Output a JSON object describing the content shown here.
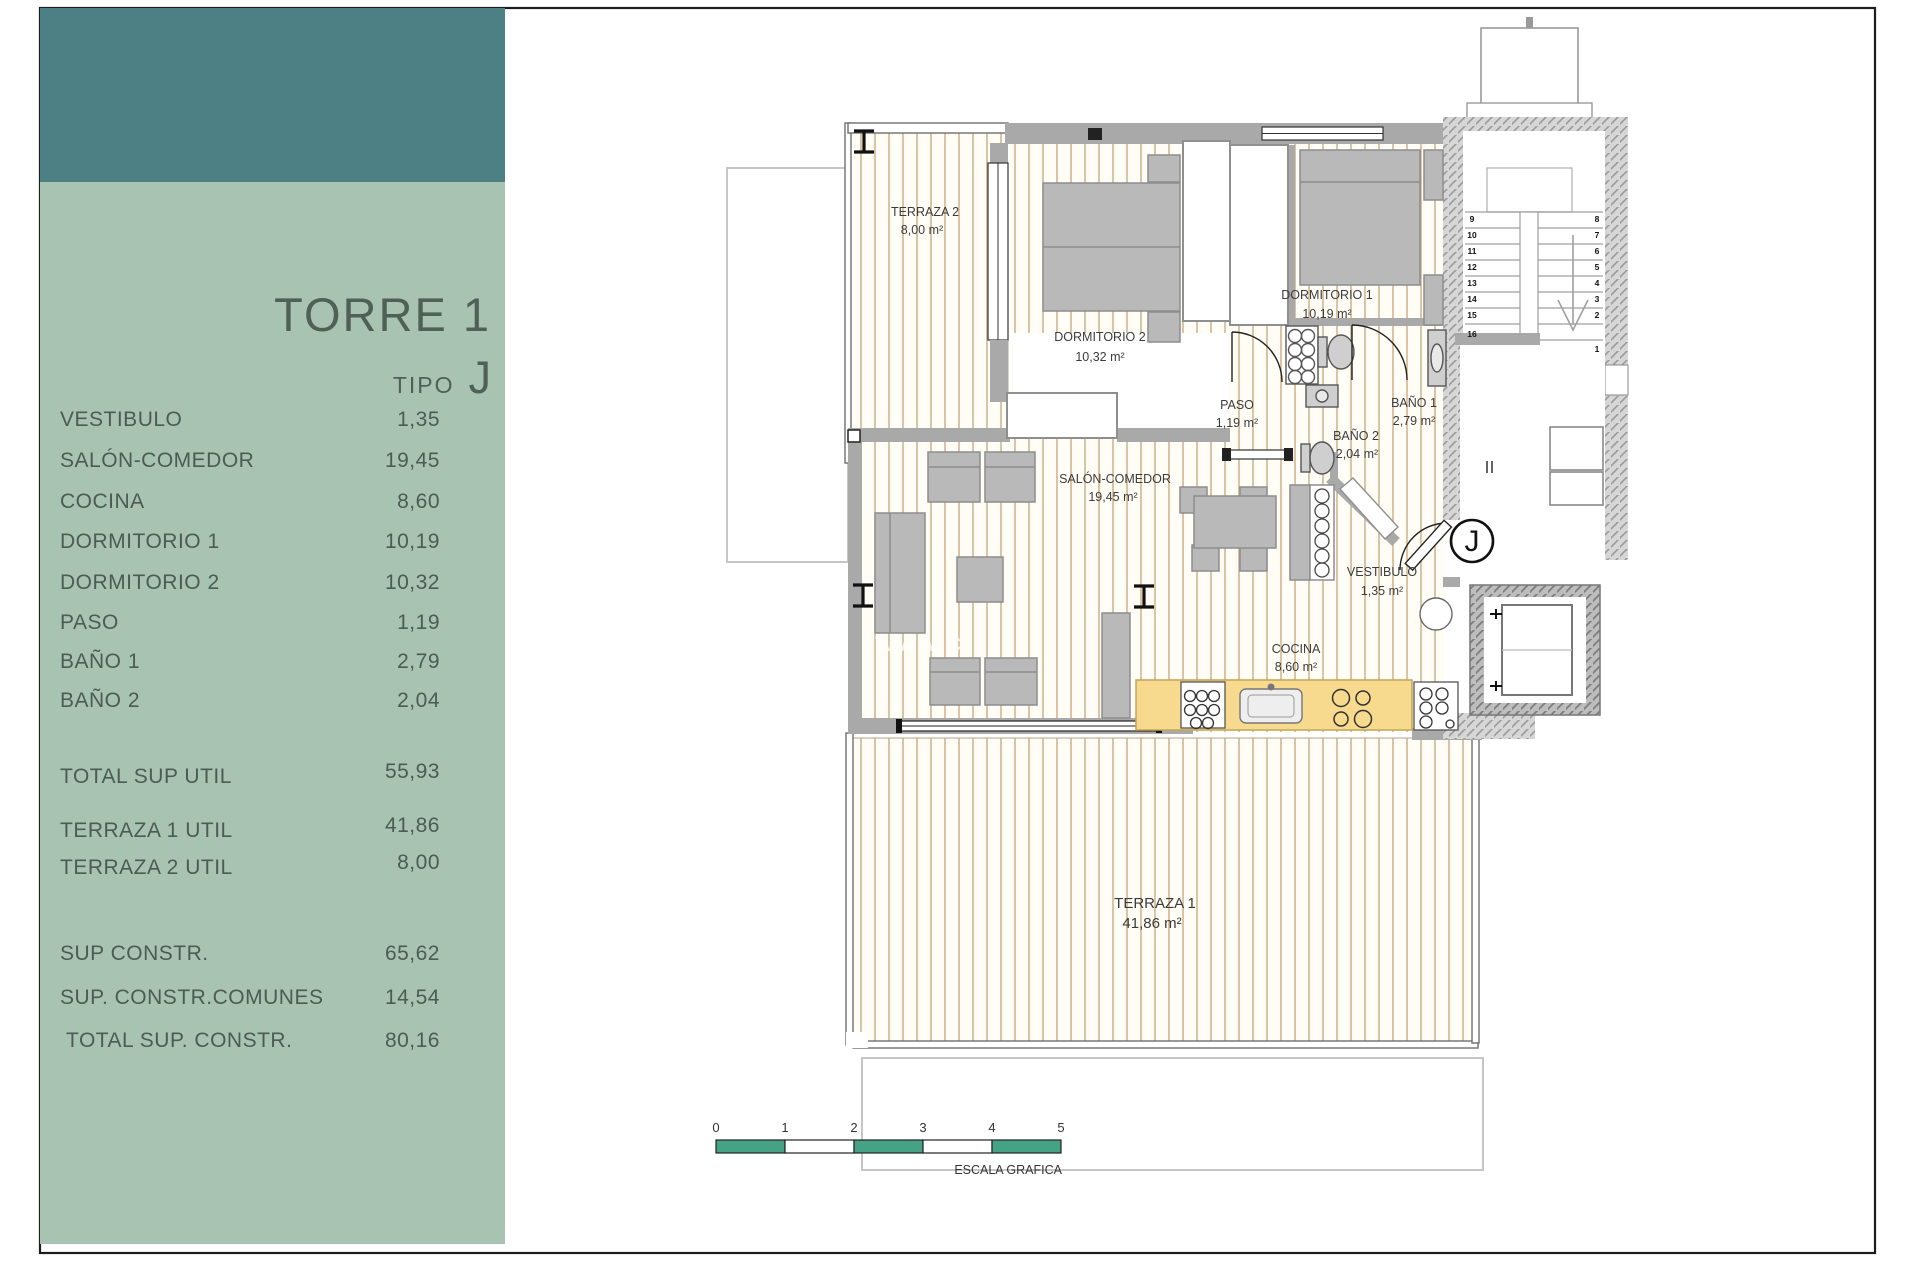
{
  "sidebar": {
    "title": "TORRE 1",
    "tipo_label": "TIPO",
    "tipo_value": "J",
    "rows": [
      {
        "label": "VESTIBULO",
        "value": "1,35"
      },
      {
        "label": "SALÓN-COMEDOR",
        "value": "19,45"
      },
      {
        "label": "COCINA",
        "value": "8,60"
      },
      {
        "label": "DORMITORIO 1",
        "value": "10,19"
      },
      {
        "label": "DORMITORIO 2",
        "value": "10,32"
      },
      {
        "label": "PASO",
        "value": "1,19"
      },
      {
        "label": "BAÑO 1",
        "value": "2,79"
      },
      {
        "label": "BAÑO 2",
        "value": "2,04"
      }
    ],
    "totals": [
      {
        "label": "TOTAL SUP UTIL",
        "value": "55,93"
      },
      {
        "label": "TERRAZA 1 UTIL",
        "value": "41,86"
      },
      {
        "label": "TERRAZA 2 UTIL",
        "value": "8,00"
      }
    ],
    "constr": [
      {
        "label": "SUP CONSTR.",
        "value": "65,62"
      },
      {
        "label": "SUP. CONSTR.COMUNES",
        "value": "14,54"
      },
      {
        "label": "TOTAL SUP. CONSTR.",
        "value": "80,16"
      }
    ]
  },
  "plan": {
    "unit_badge": "J",
    "watermark": "www.c",
    "rooms": [
      {
        "name": "TERRAZA 2",
        "area": "8,00 m²"
      },
      {
        "name": "DORMITORIO 2",
        "area": "10,32 m²"
      },
      {
        "name": "DORMITORIO 1",
        "area": "10,19 m²"
      },
      {
        "name": "PASO",
        "area": "1,19 m²"
      },
      {
        "name": "BAÑO 1",
        "area": "2,79 m²"
      },
      {
        "name": "BAÑO 2",
        "area": "2,04 m²"
      },
      {
        "name": "SALÓN-COMEDOR",
        "area": "19,45 m²"
      },
      {
        "name": "VESTIBULO",
        "area": "1,35 m²"
      },
      {
        "name": "COCINA",
        "area": "8,60 m²"
      },
      {
        "name": "TERRAZA 1",
        "area": "41,86 m²"
      }
    ],
    "stair_left": [
      "9",
      "10",
      "11",
      "12",
      "13",
      "14",
      "15",
      "16"
    ],
    "stair_right": [
      "8",
      "7",
      "6",
      "5",
      "4",
      "3",
      "2",
      "1"
    ]
  },
  "scalebar": {
    "ticks": [
      "0",
      "1",
      "2",
      "3",
      "4",
      "5"
    ],
    "caption": "ESCALA GRAFICA"
  },
  "colors": {
    "header_teal": "#4d8084",
    "panel_green": "#a9c3b2",
    "scale_green": "#45a285",
    "counter_yellow": "#f7da8e",
    "floor_stripe": "#c8a67a",
    "wall_gray": "#a9a9a9"
  }
}
